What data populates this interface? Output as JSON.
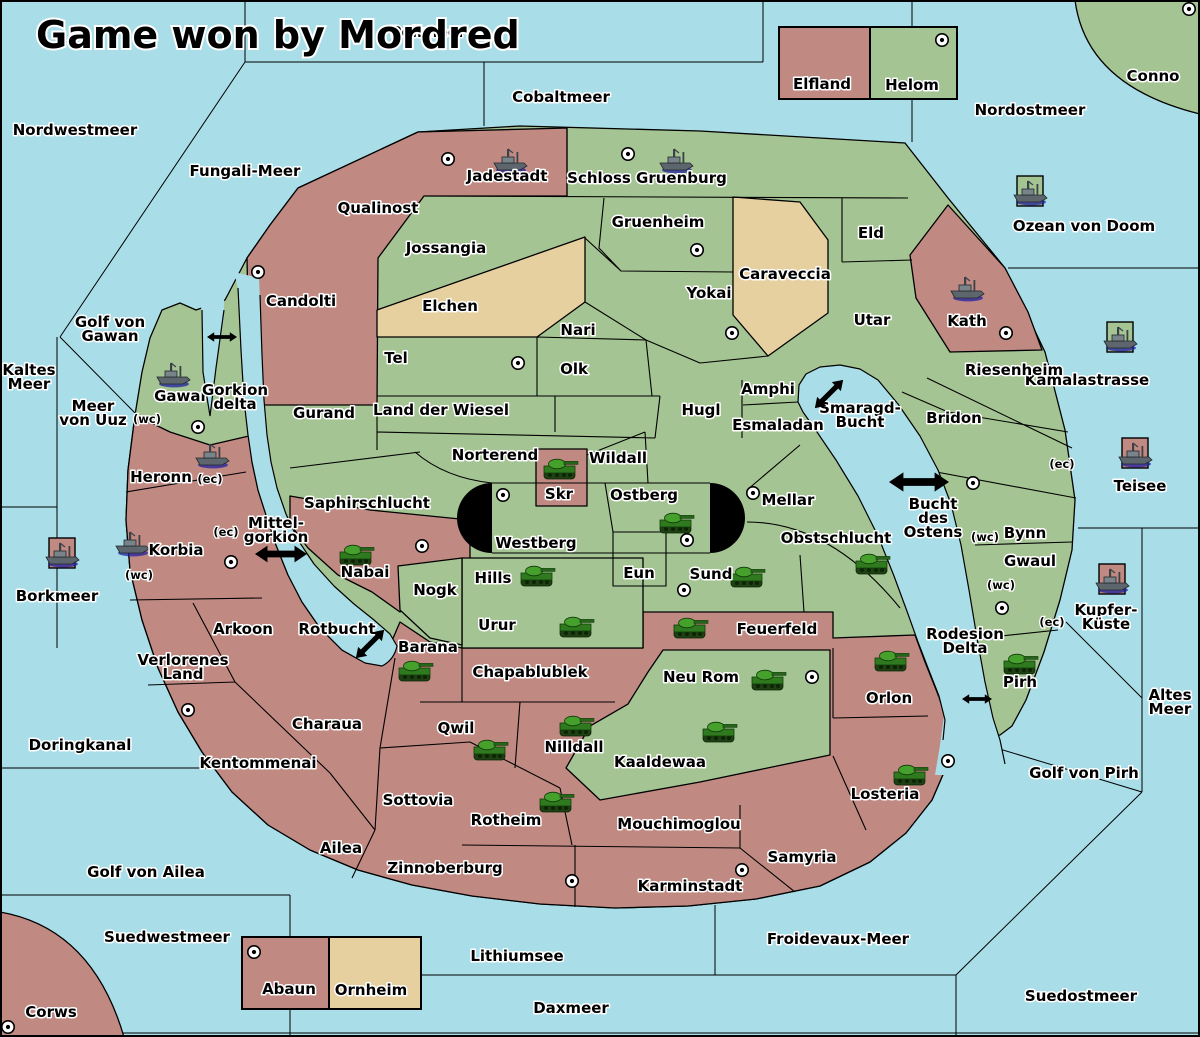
{
  "title": "Game won by Mordred",
  "colors": {
    "sea": "#a9dee9",
    "owner_red": "#c08a83",
    "owner_green": "#a5c493",
    "owner_tan": "#e7d0a0",
    "border": "#000000",
    "tank_unit": "#3f8f28",
    "ship_unit": "#5c666c",
    "ship_shadow": "#2020a0",
    "marker_black": "#000000"
  },
  "icon_legend": {
    "city": "circle-with-dot city marker",
    "tank": "green tank land unit",
    "ship": "grey warship naval unit",
    "tile": "owner-colored square under ships at sea",
    "arrow": "black double-headed strait-crossing arrow"
  },
  "map": {
    "sea_labels": [
      {
        "name": "Nordwestmeer",
        "x": 75,
        "y": 131
      },
      {
        "name": "Fungali-Meer",
        "x": 245,
        "y": 172
      },
      {
        "name": "Pollmeer",
        "x": 428,
        "y": 33,
        "note": "partially obscured by title"
      },
      {
        "name": "Cobaltmeer",
        "x": 561,
        "y": 98
      },
      {
        "name": "Nordostmeer",
        "x": 1030,
        "y": 111
      },
      {
        "name": "Ozean von Doom",
        "x": 1084,
        "y": 227
      },
      {
        "name": "Kamalastrasse",
        "x": 1087,
        "y": 381
      },
      {
        "name": "Kaltes\nMeer",
        "x": 29,
        "y": 371
      },
      {
        "name": "Golf von\nGawan",
        "x": 110,
        "y": 323
      },
      {
        "name": "Meer\nvon Uuz",
        "x": 93,
        "y": 407
      },
      {
        "name": "Borkmeer",
        "x": 57,
        "y": 597
      },
      {
        "name": "Mittel-\ngorkion",
        "x": 276,
        "y": 524
      },
      {
        "name": "Rotbucht",
        "x": 337,
        "y": 630
      },
      {
        "name": "Smaragd-\nBucht",
        "x": 860,
        "y": 409
      },
      {
        "name": "Bucht\ndes\nOstens",
        "x": 933,
        "y": 505
      },
      {
        "name": "Teisee",
        "x": 1140,
        "y": 487
      },
      {
        "name": "Kupfer-\nKüste",
        "x": 1106,
        "y": 611
      },
      {
        "name": "Altes\nMeer",
        "x": 1170,
        "y": 696
      },
      {
        "name": "Rodesion\nDelta",
        "x": 965,
        "y": 635
      },
      {
        "name": "Golf von Pirh",
        "x": 1084,
        "y": 774
      },
      {
        "name": "Doringkanal",
        "x": 80,
        "y": 746
      },
      {
        "name": "Golf von Ailea",
        "x": 146,
        "y": 873
      },
      {
        "name": "Suedwestmeer",
        "x": 167,
        "y": 938
      },
      {
        "name": "Lithiumsee",
        "x": 517,
        "y": 957
      },
      {
        "name": "Daxmeer",
        "x": 571,
        "y": 1009
      },
      {
        "name": "Froidevaux-Meer",
        "x": 838,
        "y": 940
      },
      {
        "name": "Suedostmeer",
        "x": 1081,
        "y": 997
      }
    ],
    "territories": [
      {
        "name": "Jadestadt",
        "x": 507,
        "y": 177,
        "owner": "red"
      },
      {
        "name": "Schloss Gruenburg",
        "x": 647,
        "y": 179,
        "owner": "green"
      },
      {
        "name": "Qualinost",
        "x": 378,
        "y": 209,
        "owner": "red"
      },
      {
        "name": "Jossangia",
        "x": 446,
        "y": 249,
        "owner": "green"
      },
      {
        "name": "Candolti",
        "x": 301,
        "y": 302,
        "owner": "red"
      },
      {
        "name": "Gruenheim",
        "x": 658,
        "y": 223,
        "owner": "green"
      },
      {
        "name": "Yokai",
        "x": 709,
        "y": 294,
        "owner": "green"
      },
      {
        "name": "Caraveccia",
        "x": 785,
        "y": 275,
        "owner": "tan"
      },
      {
        "name": "Elchen",
        "x": 450,
        "y": 307,
        "owner": "tan"
      },
      {
        "name": "Eld",
        "x": 871,
        "y": 234,
        "owner": "green"
      },
      {
        "name": "Utar",
        "x": 872,
        "y": 321,
        "owner": "green"
      },
      {
        "name": "Kath",
        "x": 967,
        "y": 322,
        "owner": "red"
      },
      {
        "name": "Riesenheim",
        "x": 1014,
        "y": 371,
        "owner": "green"
      },
      {
        "name": "Bridon",
        "x": 954,
        "y": 419,
        "owner": "green"
      },
      {
        "name": "Nari",
        "x": 578,
        "y": 331,
        "owner": "green"
      },
      {
        "name": "Olk",
        "x": 574,
        "y": 370,
        "owner": "green"
      },
      {
        "name": "Tel",
        "x": 396,
        "y": 359,
        "owner": "green"
      },
      {
        "name": "Gurand",
        "x": 324,
        "y": 414,
        "owner": "green"
      },
      {
        "name": "Land der Wiesel",
        "x": 441,
        "y": 411,
        "owner": "green"
      },
      {
        "name": "Hugl",
        "x": 701,
        "y": 411,
        "owner": "green"
      },
      {
        "name": "Amphi",
        "x": 768,
        "y": 390,
        "owner": "green"
      },
      {
        "name": "Esmaladan",
        "x": 778,
        "y": 426,
        "owner": "green"
      },
      {
        "name": "Gawar",
        "x": 181,
        "y": 397,
        "owner": "green"
      },
      {
        "name": "Gorkion\ndelta",
        "x": 235,
        "y": 391,
        "owner": "green"
      },
      {
        "name": "Norterend",
        "x": 495,
        "y": 456,
        "owner": "green"
      },
      {
        "name": "Wildall",
        "x": 618,
        "y": 459,
        "owner": "green"
      },
      {
        "name": "Skr",
        "x": 559,
        "y": 495,
        "owner": "red"
      },
      {
        "name": "Ostberg",
        "x": 644,
        "y": 496,
        "owner": "green"
      },
      {
        "name": "Westberg",
        "x": 536,
        "y": 544,
        "owner": "green"
      },
      {
        "name": "Mellar",
        "x": 788,
        "y": 501,
        "owner": "green"
      },
      {
        "name": "Obstschlucht",
        "x": 836,
        "y": 539,
        "owner": "green"
      },
      {
        "name": "Saphirschlucht",
        "x": 367,
        "y": 504,
        "owner": "green"
      },
      {
        "name": "Heronn",
        "x": 161,
        "y": 478,
        "owner": "red"
      },
      {
        "name": "Korbia",
        "x": 176,
        "y": 551,
        "owner": "red"
      },
      {
        "name": "Nabai",
        "x": 365,
        "y": 573,
        "owner": "red"
      },
      {
        "name": "Nogk",
        "x": 435,
        "y": 591,
        "owner": "green"
      },
      {
        "name": "Eun",
        "x": 639,
        "y": 574,
        "owner": "green"
      },
      {
        "name": "Hills",
        "x": 493,
        "y": 579,
        "owner": "green"
      },
      {
        "name": "Sund",
        "x": 711,
        "y": 575,
        "owner": "green"
      },
      {
        "name": "Urur",
        "x": 497,
        "y": 626,
        "owner": "green"
      },
      {
        "name": "Feuerfeld",
        "x": 777,
        "y": 630,
        "owner": "red"
      },
      {
        "name": "Barana",
        "x": 428,
        "y": 648,
        "owner": "red"
      },
      {
        "name": "Chapablublek",
        "x": 530,
        "y": 673,
        "owner": "red"
      },
      {
        "name": "Neu Rom",
        "x": 701,
        "y": 678,
        "owner": "green"
      },
      {
        "name": "Orlon",
        "x": 889,
        "y": 699,
        "owner": "red"
      },
      {
        "name": "Arkoon",
        "x": 243,
        "y": 630,
        "owner": "red"
      },
      {
        "name": "Verlorenes\nLand",
        "x": 183,
        "y": 661,
        "owner": "red"
      },
      {
        "name": "Kentommenai",
        "x": 258,
        "y": 764,
        "owner": "red"
      },
      {
        "name": "Charaua",
        "x": 327,
        "y": 725,
        "owner": "red"
      },
      {
        "name": "Qwil",
        "x": 456,
        "y": 729,
        "owner": "red"
      },
      {
        "name": "Nilldall",
        "x": 574,
        "y": 748,
        "owner": "red"
      },
      {
        "name": "Kaaldewaa",
        "x": 660,
        "y": 763,
        "owner": "green"
      },
      {
        "name": "Sottovia",
        "x": 418,
        "y": 801,
        "owner": "red"
      },
      {
        "name": "Rotheim",
        "x": 506,
        "y": 821,
        "owner": "red"
      },
      {
        "name": "Ailea",
        "x": 341,
        "y": 849,
        "owner": "red"
      },
      {
        "name": "Zinnoberburg",
        "x": 445,
        "y": 869,
        "owner": "red"
      },
      {
        "name": "Mouchimoglou",
        "x": 679,
        "y": 825,
        "owner": "red"
      },
      {
        "name": "Karminstadt",
        "x": 690,
        "y": 887,
        "owner": "red"
      },
      {
        "name": "Samyria",
        "x": 802,
        "y": 858,
        "owner": "red"
      },
      {
        "name": "Losteria",
        "x": 885,
        "y": 795,
        "owner": "red"
      },
      {
        "name": "Bynn",
        "x": 1025,
        "y": 534,
        "owner": "green"
      },
      {
        "name": "Gwaul",
        "x": 1030,
        "y": 562,
        "owner": "green"
      },
      {
        "name": "Pirh",
        "x": 1020,
        "y": 683,
        "owner": "green"
      },
      {
        "name": "Conno",
        "x": 1153,
        "y": 77,
        "owner": "green"
      },
      {
        "name": "Corws",
        "x": 51,
        "y": 1013,
        "owner": "red"
      },
      {
        "name": "Elfland",
        "x": 822,
        "y": 85,
        "owner": "red"
      },
      {
        "name": "Helom",
        "x": 912,
        "y": 86,
        "owner": "green"
      },
      {
        "name": "Abaun",
        "x": 289,
        "y": 990,
        "owner": "red"
      },
      {
        "name": "Ornheim",
        "x": 371,
        "y": 991,
        "owner": "tan"
      }
    ],
    "cities": [
      {
        "x": 448,
        "y": 159
      },
      {
        "x": 628,
        "y": 154
      },
      {
        "x": 942,
        "y": 40
      },
      {
        "x": 1189,
        "y": 9
      },
      {
        "x": 258,
        "y": 272
      },
      {
        "x": 697,
        "y": 250
      },
      {
        "x": 732,
        "y": 333
      },
      {
        "x": 1006,
        "y": 333
      },
      {
        "x": 518,
        "y": 363
      },
      {
        "x": 198,
        "y": 427
      },
      {
        "x": 231,
        "y": 562
      },
      {
        "x": 503,
        "y": 495
      },
      {
        "x": 687,
        "y": 540
      },
      {
        "x": 753,
        "y": 493
      },
      {
        "x": 684,
        "y": 590
      },
      {
        "x": 422,
        "y": 546
      },
      {
        "x": 188,
        "y": 710
      },
      {
        "x": 572,
        "y": 881
      },
      {
        "x": 254,
        "y": 952
      },
      {
        "x": 8,
        "y": 1027
      },
      {
        "x": 812,
        "y": 677
      },
      {
        "x": 742,
        "y": 870
      },
      {
        "x": 948,
        "y": 761
      },
      {
        "x": 1002,
        "y": 608
      },
      {
        "x": 973,
        "y": 483
      }
    ],
    "tanks": [
      {
        "x": 560,
        "y": 470
      },
      {
        "x": 676,
        "y": 524
      },
      {
        "x": 537,
        "y": 577
      },
      {
        "x": 747,
        "y": 578
      },
      {
        "x": 872,
        "y": 565
      },
      {
        "x": 356,
        "y": 556
      },
      {
        "x": 576,
        "y": 628
      },
      {
        "x": 690,
        "y": 629
      },
      {
        "x": 768,
        "y": 681
      },
      {
        "x": 415,
        "y": 672
      },
      {
        "x": 490,
        "y": 751
      },
      {
        "x": 576,
        "y": 727
      },
      {
        "x": 719,
        "y": 733
      },
      {
        "x": 556,
        "y": 803
      },
      {
        "x": 910,
        "y": 776
      },
      {
        "x": 891,
        "y": 662
      },
      {
        "x": 1020,
        "y": 665
      }
    ],
    "ships": [
      {
        "x": 510,
        "y": 161,
        "tile": null
      },
      {
        "x": 676,
        "y": 161,
        "tile": null
      },
      {
        "x": 967,
        "y": 289,
        "tile": null
      },
      {
        "x": 173,
        "y": 375,
        "tile": null
      },
      {
        "x": 212,
        "y": 456,
        "tile": null
      },
      {
        "x": 132,
        "y": 544,
        "tile": null
      },
      {
        "x": 1030,
        "y": 193,
        "tile": "green"
      },
      {
        "x": 1120,
        "y": 339,
        "tile": "green"
      },
      {
        "x": 1135,
        "y": 455,
        "tile": "red"
      },
      {
        "x": 1112,
        "y": 581,
        "tile": "red"
      },
      {
        "x": 62,
        "y": 555,
        "tile": "red"
      }
    ],
    "coast_markers": [
      {
        "text": "(wc)",
        "x": 147,
        "y": 419
      },
      {
        "text": "(ec)",
        "x": 210,
        "y": 479
      },
      {
        "text": "(ec)",
        "x": 226,
        "y": 532
      },
      {
        "text": "(wc)",
        "x": 139,
        "y": 575
      },
      {
        "text": "(wc)",
        "x": 985,
        "y": 537
      },
      {
        "text": "(ec)",
        "x": 1062,
        "y": 464
      },
      {
        "text": "(wc)",
        "x": 1001,
        "y": 585
      },
      {
        "text": "(ec)",
        "x": 1052,
        "y": 622
      }
    ],
    "arrows": [
      {
        "x": 222,
        "y": 337,
        "rot": 0,
        "len": 30
      },
      {
        "x": 281,
        "y": 554,
        "rot": 0,
        "len": 52
      },
      {
        "x": 370,
        "y": 644,
        "rot": -45,
        "len": 40
      },
      {
        "x": 829,
        "y": 394,
        "rot": -45,
        "len": 40
      },
      {
        "x": 919,
        "y": 482,
        "rot": 0,
        "len": 60
      },
      {
        "x": 977,
        "y": 699,
        "rot": 0,
        "len": 30
      }
    ]
  }
}
